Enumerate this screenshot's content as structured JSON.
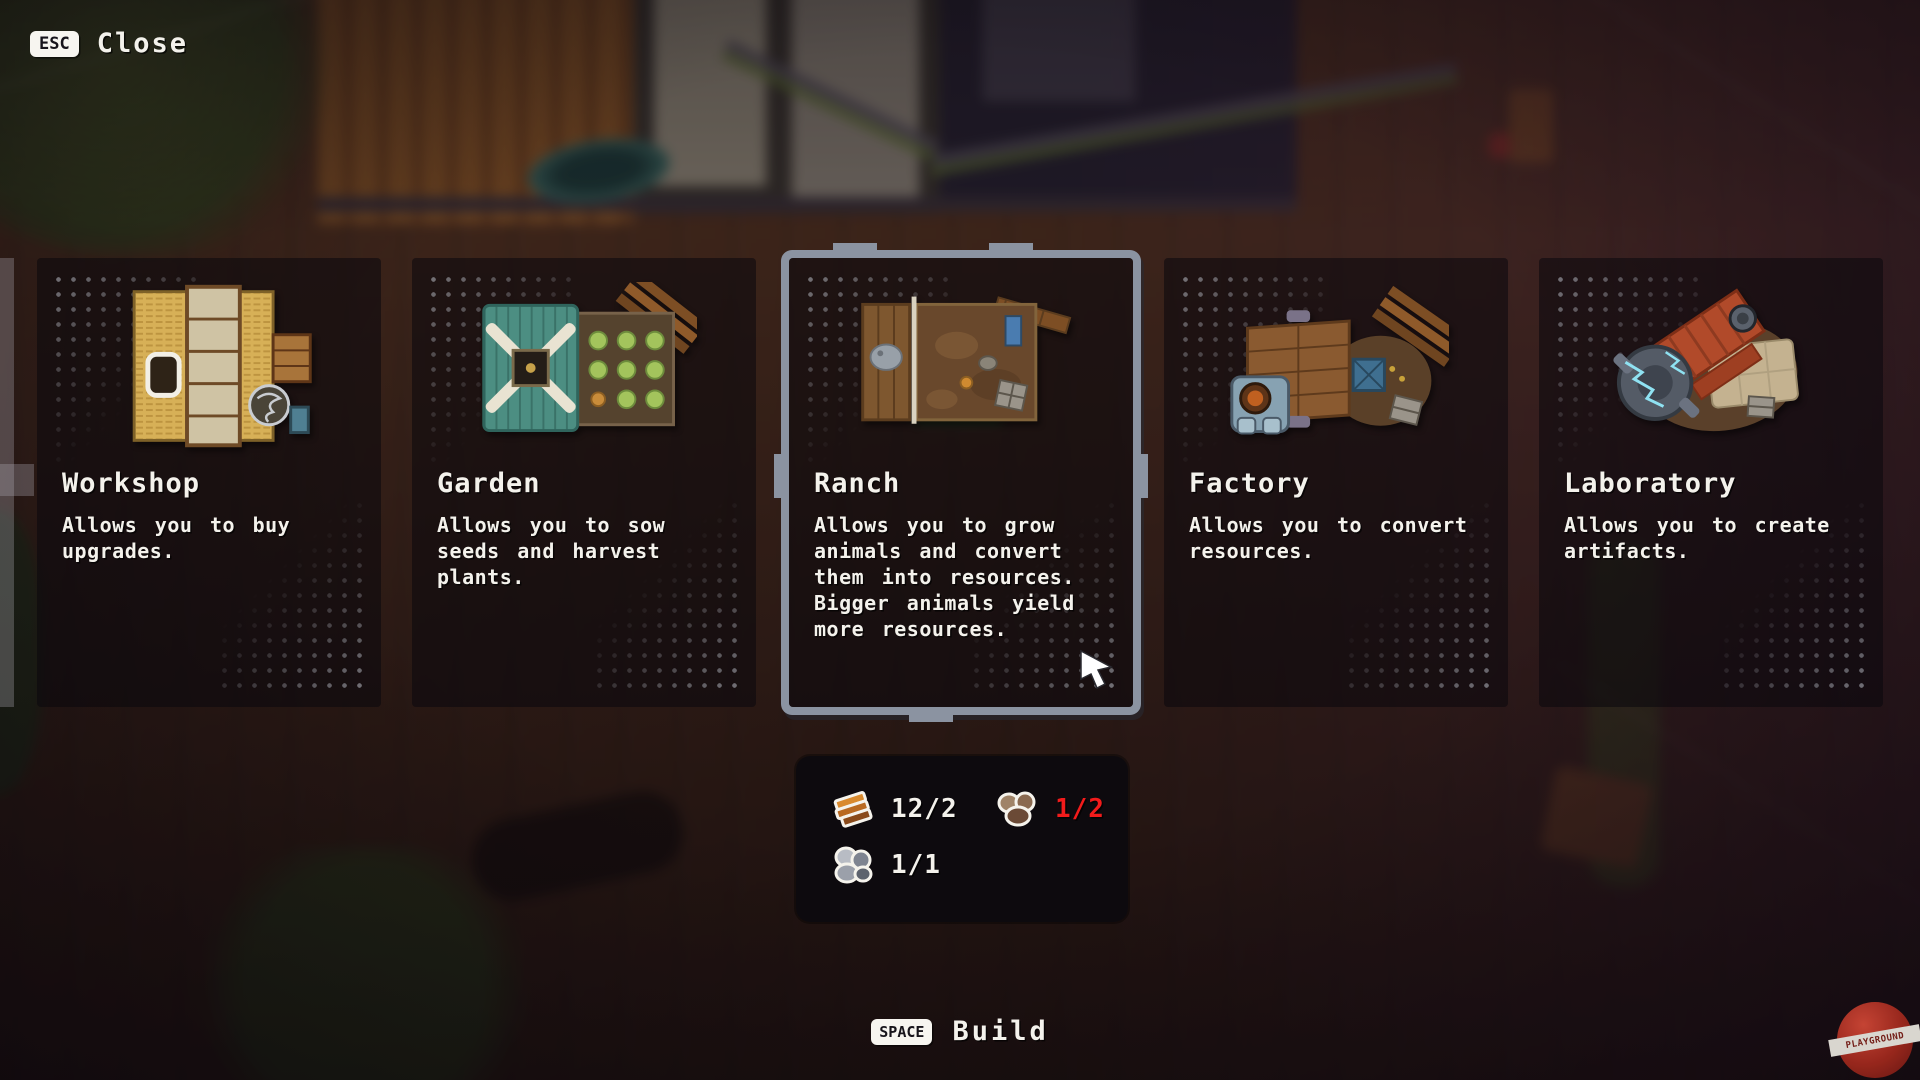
{
  "header": {
    "close_key": "ESC",
    "close_label": "Close"
  },
  "cards": [
    {
      "title": "Workshop",
      "description": "Allows you to buy upgrades.",
      "selected": false
    },
    {
      "title": "Garden",
      "description": "Allows you to sow seeds and harvest plants.",
      "selected": false
    },
    {
      "title": "Ranch",
      "description": "Allows you to grow animals and convert them into resources. Bigger animals yield more resources.",
      "selected": true
    },
    {
      "title": "Factory",
      "description": "Allows you to convert resources.",
      "selected": false
    },
    {
      "title": "Laboratory",
      "description": "Allows you to create artifacts.",
      "selected": false
    }
  ],
  "cost_panel": {
    "items": [
      {
        "icon": "wood-planks-icon",
        "label": "12/2",
        "insufficient": false
      },
      {
        "icon": "brown-rocks-icon",
        "label": "1/2",
        "insufficient": true
      },
      {
        "icon": "gray-rocks-icon",
        "label": "1/1",
        "insufficient": false
      }
    ]
  },
  "footer": {
    "build_key": "SPACE",
    "build_label": "Build"
  },
  "watermark": {
    "label": "PLAYGROUND"
  },
  "colors": {
    "selection_border": "#8b93a1",
    "insufficient_red": "#f21b1b",
    "cost_panel_bg": "#0c0a0e",
    "green_bar": "#3f7c35",
    "key_badge_bg": "#f7f5f0"
  }
}
